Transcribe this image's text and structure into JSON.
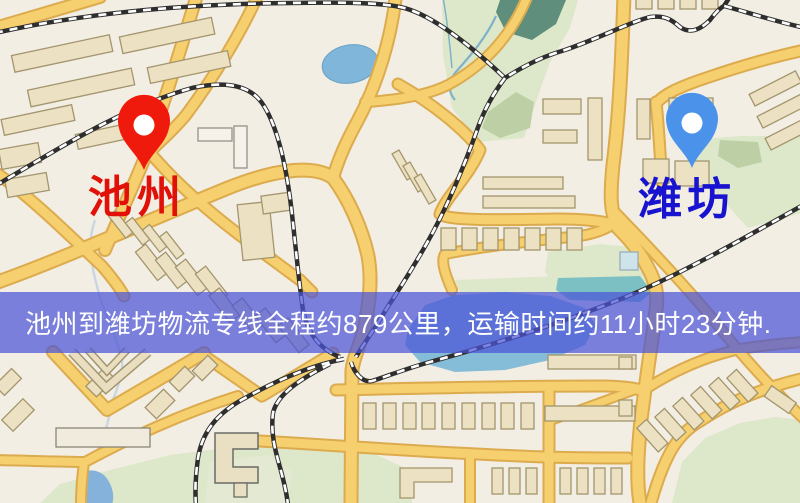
{
  "app": {
    "type": "logistics-route-map"
  },
  "map": {
    "background": "#f3eee4",
    "road_fill": "#f6cf6f",
    "road_casing": "#dcab4e",
    "water_color": "#7fb6da",
    "green_color": "#dde7ca",
    "railway_color": "#2e2e2e"
  },
  "cities": [
    {
      "id": "chizhou",
      "name": "池州",
      "label_color": "#e11008",
      "pin_color": "#f01a0c"
    },
    {
      "id": "weifang",
      "name": "潍坊",
      "label_color": "#1813cf",
      "pin_color": "#4b93ea"
    }
  ],
  "banner": {
    "text": "池州到潍坊物流专线全程约879公里，运输时间约11小时23分钟.",
    "background": "rgba(75,85,215,0.72)",
    "text_color": "#ffffff"
  }
}
